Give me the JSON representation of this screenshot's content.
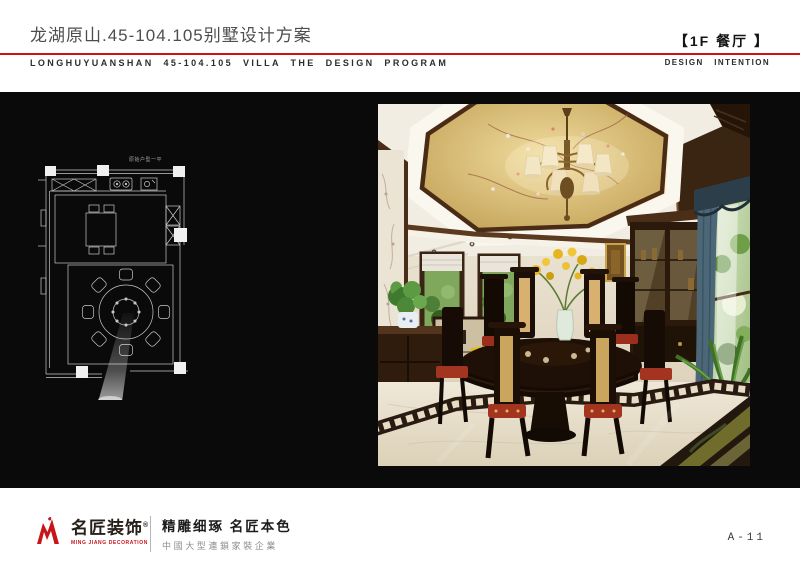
{
  "page": {
    "bg": "#ffffff",
    "accent_red": "#cc1217",
    "panel_black": "#0a0a0a",
    "page_number": "A-11"
  },
  "header": {
    "title_cn": "龙湖原山.45-104.105别墅设计方案",
    "subtitle_en": "LONGHUYUANSHAN 45-104.105 VILLA THE DESIGN PROGRAM",
    "room_tag_cn": "【1F 餐厅 】",
    "room_tag_en": "DESIGN INTENTION"
  },
  "board": {
    "floor_plan_label": "原始户型一平",
    "palette": {
      "plan_line": "#c8c8c8",
      "ceiling_gold": "#c9a450",
      "wood_dark": "#3a2414",
      "curtain_teal": "#4c6878",
      "floor_cream": "#e9e1d0",
      "cushion_red": "#9e2e1c",
      "plant_green": "#5d9a44"
    }
  },
  "footer": {
    "logo_cn": "名匠装饰",
    "logo_reg": "®",
    "logo_en": "MING JIANG DECORATION",
    "slogan_main": "精雕细琢 名匠本色",
    "slogan_sub": "中國大型連鎖家裝企業"
  }
}
